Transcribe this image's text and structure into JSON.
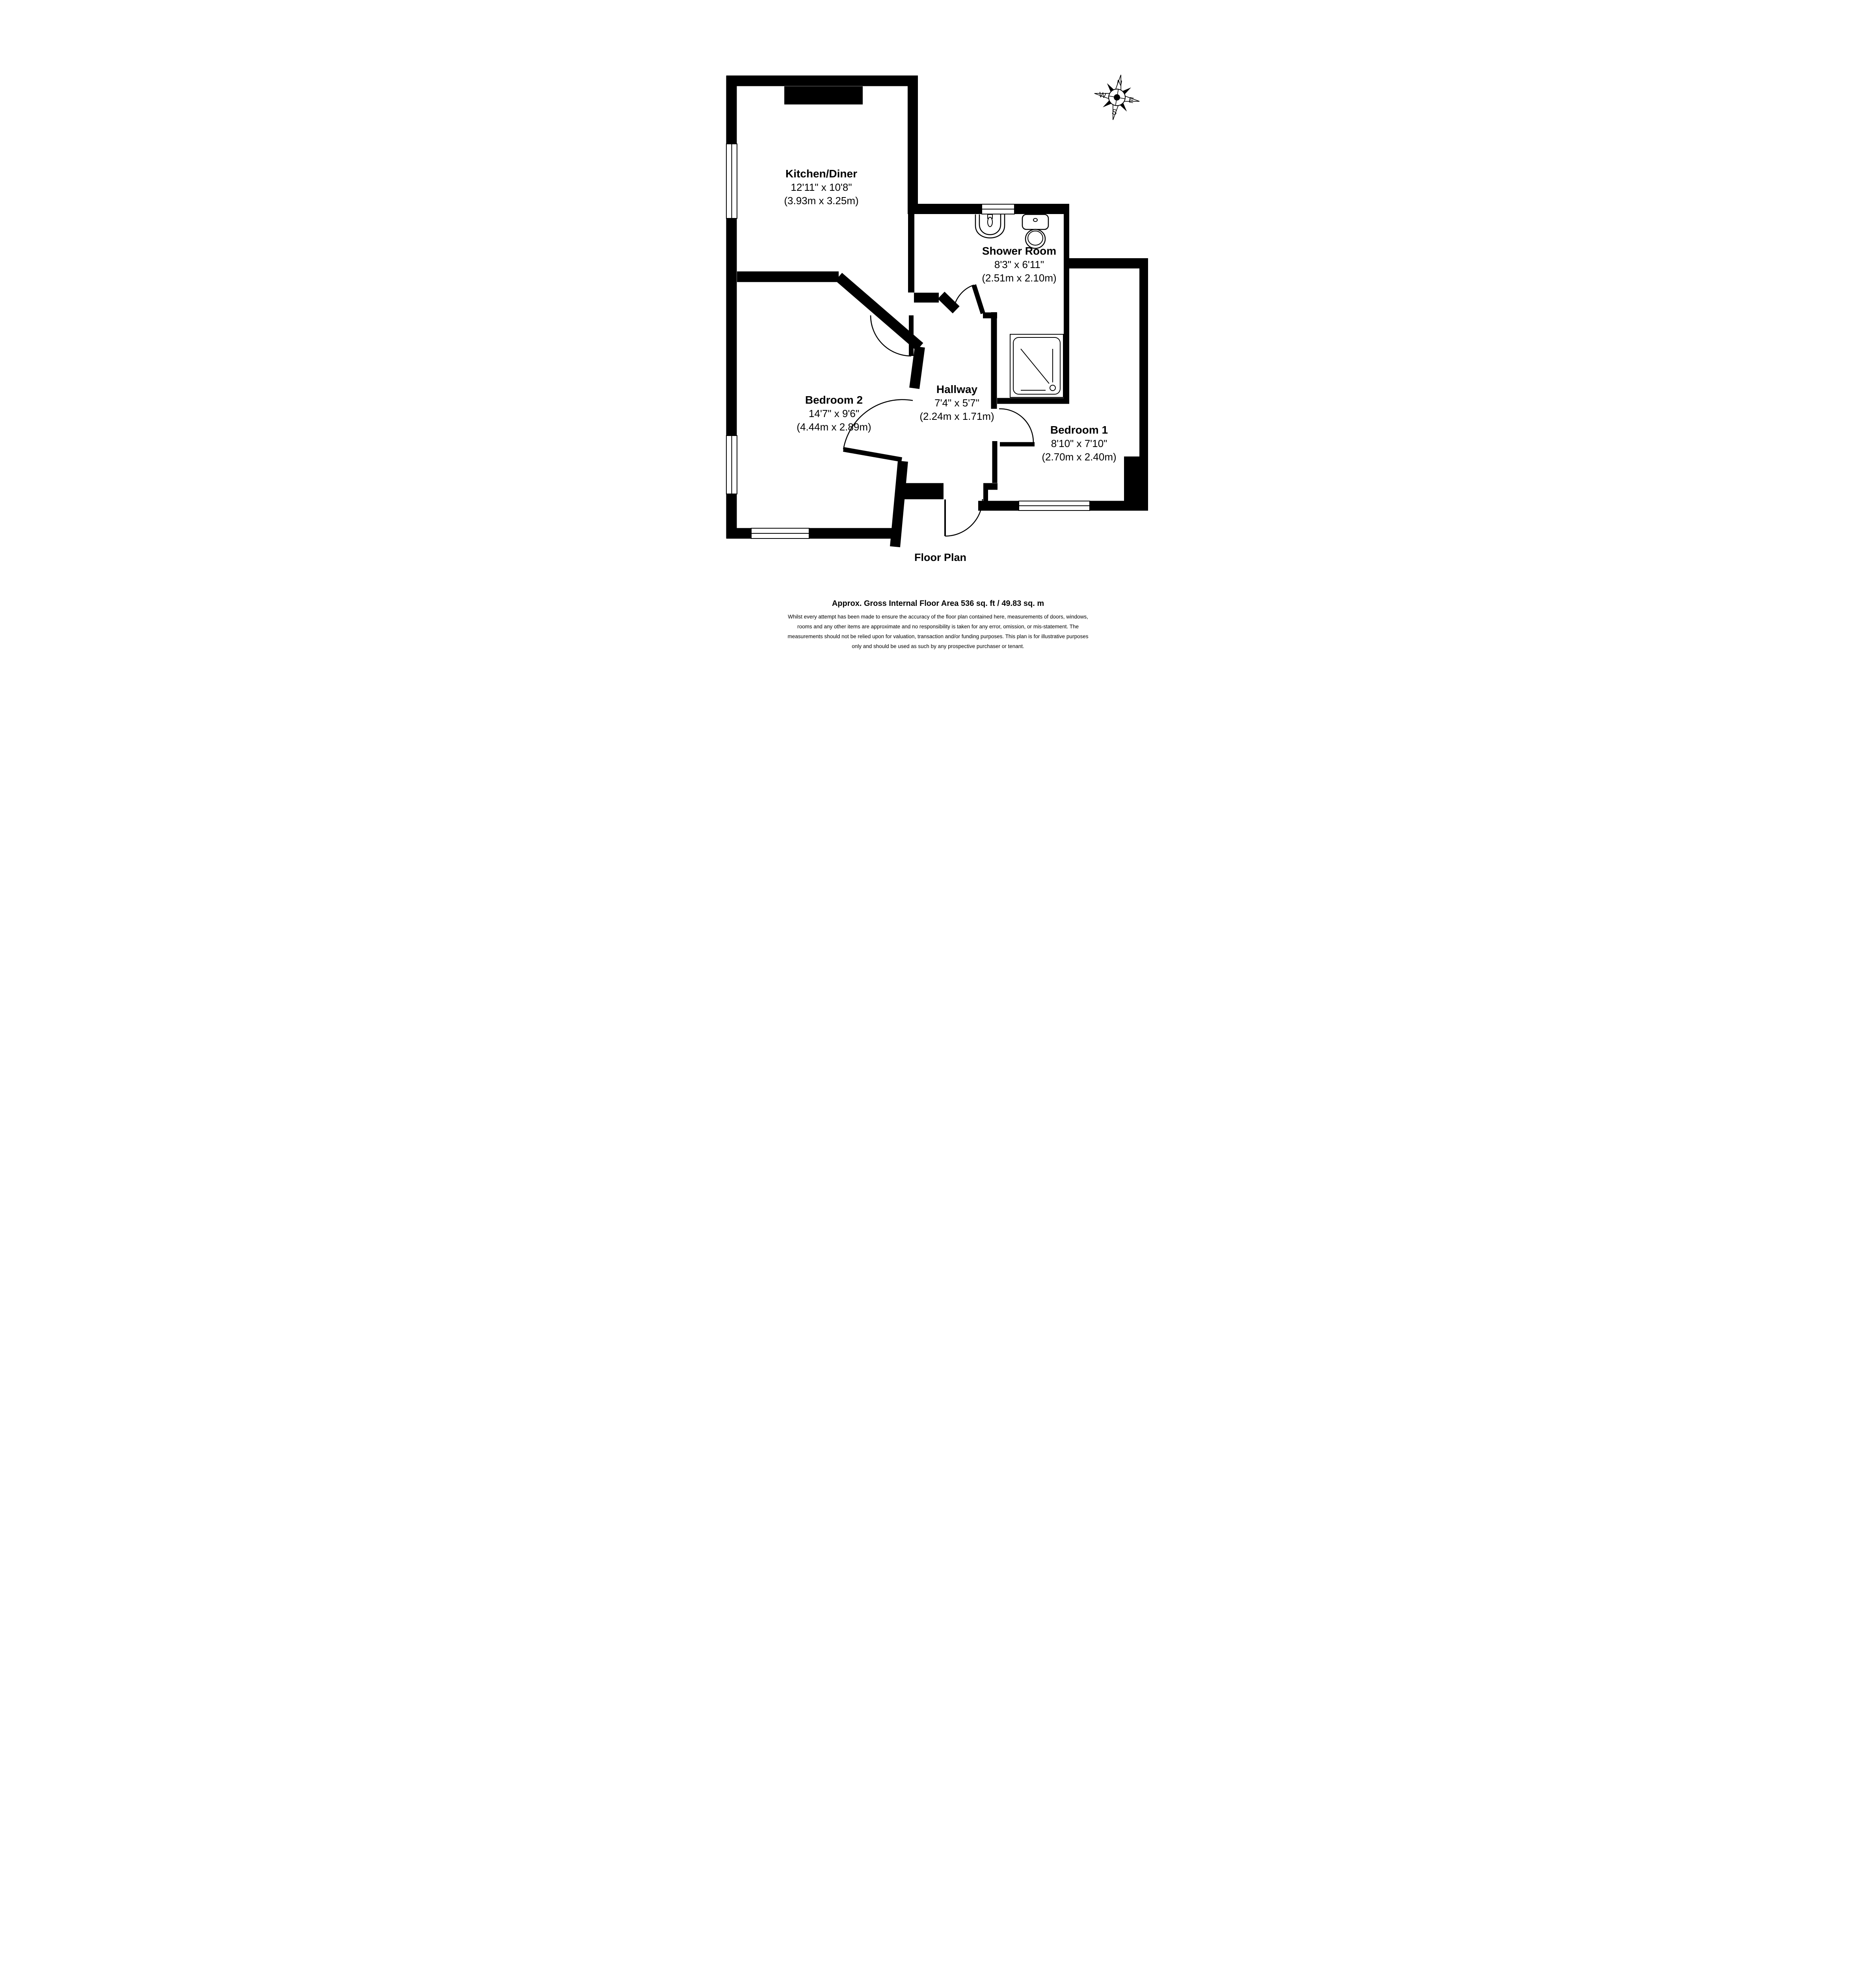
{
  "page": {
    "title": "Floor Plan"
  },
  "compass": {
    "north": "N",
    "east": "E",
    "south": "S",
    "west": "W"
  },
  "rooms": {
    "kitchen": {
      "name": "Kitchen/Diner",
      "imperial": "12'11\" x 10'8\"",
      "metric": "(3.93m x 3.25m)"
    },
    "shower": {
      "name": "Shower Room",
      "imperial": "8'3\" x 6'11\"",
      "metric": "(2.51m x 2.10m)"
    },
    "bedroom2": {
      "name": "Bedroom 2",
      "imperial": "14'7\" x 9'6\"",
      "metric": "(4.44m x 2.89m)"
    },
    "hallway": {
      "name": "Hallway",
      "imperial": "7'4\" x 5'7\"",
      "metric": "(2.24m x 1.71m)"
    },
    "bedroom1": {
      "name": "Bedroom 1",
      "imperial": "8'10\" x 7'10\"",
      "metric": "(2.70m x 2.40m)"
    }
  },
  "footer": {
    "area": "Approx. Gross Internal Floor Area 536 sq. ft / 49.83 sq. m",
    "disclaimer": [
      "Whilst every attempt has been made to ensure the accuracy of the floor plan contained here, measurements of doors, windows,",
      "rooms and any other items are approximate and no responsibility is taken for any error, omission, or mis-statement. The",
      "measurements should not be relied upon for valuation, transaction and/or funding purposes. This plan is for illustrative purposes",
      "only and should be used as such by any prospective purchaser or tenant."
    ]
  }
}
